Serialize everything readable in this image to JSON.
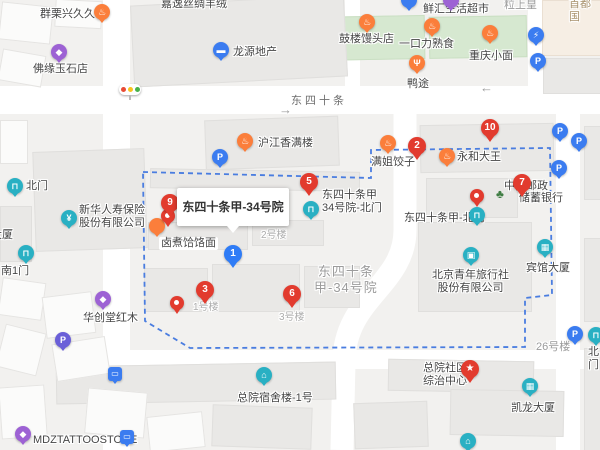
{
  "tooltip": {
    "text": "东四十条甲-34号院"
  },
  "colors": {
    "marker_red": "#e23b2e",
    "marker_blue": "#2f7cf6",
    "marker_teal": "#29b0c3",
    "marker_orange": "#fb7e3b",
    "marker_purple": "#9d62d4",
    "parking_blue": "#3b7cf0",
    "boundary_blue": "#4a7de0",
    "road_white": "#ffffff",
    "map_bg": "#f2f1ef",
    "green_area": "#d6e8d0",
    "building_grey": "#e9e8e6"
  },
  "labels": [
    {
      "text": "群栗兴久久鸭",
      "x": 40,
      "y": 8,
      "name": "label-qunli-duck",
      "inter": true
    },
    {
      "text": "嘉逸丝绸羊绒",
      "x": 161,
      "y": -2,
      "name": "label-jiayi-silk",
      "inter": true
    },
    {
      "text": "佛缘玉石店",
      "x": 33,
      "y": 63,
      "name": "label-foyuan-jade",
      "inter": true
    },
    {
      "text": "龙源地产",
      "x": 233,
      "y": 46,
      "name": "label-longyuan-estate",
      "inter": true
    },
    {
      "text": "鼓楼馒头店",
      "x": 339,
      "y": 33,
      "name": "label-gulou-mantou",
      "inter": true
    },
    {
      "text": "鲜汇生活超市",
      "x": 423,
      "y": 3,
      "name": "label-xianhui-market",
      "inter": true
    },
    {
      "cls": "grey",
      "text": "粒上皇",
      "x": 504,
      "y": -1,
      "name": "label-lishanghuang",
      "inter": false
    },
    {
      "cls": "tan",
      "text": "首都国",
      "x": 569,
      "y": -2,
      "name": "label-shoudu-clipped",
      "inter": false
    },
    {
      "text": "一口力熟食",
      "x": 399,
      "y": 38,
      "name": "label-yikouli-deli",
      "inter": true
    },
    {
      "text": "重庆小面",
      "x": 469,
      "y": 50,
      "name": "label-chongqing-noodles",
      "inter": true
    },
    {
      "text": "鸭途",
      "x": 407,
      "y": 78,
      "name": "label-yatu",
      "inter": true
    },
    {
      "cls": "road",
      "text": "东四十条",
      "x": 291,
      "y": 95,
      "name": "label-road-dongsishitiao",
      "inter": false
    },
    {
      "cls": "arr",
      "text": "→",
      "x": 279,
      "y": 103,
      "name": "arrow-east-icon",
      "inter": false
    },
    {
      "cls": "arr",
      "text": "←",
      "x": 480,
      "y": 81,
      "name": "arrow-west-icon",
      "inter": false
    },
    {
      "text": "北门",
      "x": 26,
      "y": 180,
      "name": "label-north-gate-left",
      "inter": true
    },
    {
      "text": "新华人寿保险\n股份有限公司",
      "x": 79,
      "y": 204,
      "name": "label-xinhua-insurance",
      "inter": true
    },
    {
      "text": "大厦",
      "x": -9,
      "y": 229,
      "name": "label-daxia-clipped",
      "inter": false
    },
    {
      "text": "南1门",
      "x": 1,
      "y": 265,
      "name": "label-south-gate-1",
      "inter": true
    },
    {
      "text": "沪江香满楼",
      "x": 258,
      "y": 137,
      "name": "label-hujiang",
      "inter": true
    },
    {
      "cls": "plate",
      "text": "卤煮饸饹面",
      "x": 159,
      "y": 237,
      "name": "label-luzhu-noodles",
      "inter": true
    },
    {
      "cls": "small",
      "text": "2号楼",
      "x": 261,
      "y": 229,
      "name": "label-bldg-2",
      "inter": false
    },
    {
      "text": "东四十条甲\n34号院-北门",
      "x": 322,
      "y": 189,
      "name": "label-34-north-gate",
      "inter": true
    },
    {
      "text": "满姐饺子",
      "x": 371,
      "y": 156,
      "name": "label-manjie-dumplings",
      "inter": true
    },
    {
      "text": "永和大王",
      "x": 457,
      "y": 151,
      "name": "label-yonghe-king",
      "inter": true
    },
    {
      "text": "中国邮政",
      "x": 504,
      "y": 180,
      "name": "label-psbc-bank-line1",
      "inter": true
    },
    {
      "text": "储蓄银行",
      "x": 519,
      "y": 192,
      "name": "label-psbc-bank-line2",
      "inter": true
    },
    {
      "cls": "tree",
      "text": "♣",
      "x": 496,
      "y": 188,
      "name": "tree-icon",
      "inter": false
    },
    {
      "text": "东四十条甲-北门",
      "x": 404,
      "y": 212,
      "name": "label-jia-north-gate",
      "inter": true
    },
    {
      "text": "宾馆大厦",
      "x": 526,
      "y": 262,
      "name": "label-binguan-tower",
      "inter": true
    },
    {
      "cls": "area",
      "text": "东四十条\n甲-34号院",
      "x": 314,
      "y": 264,
      "name": "label-area-compound",
      "inter": false
    },
    {
      "cls": "ctr",
      "text": "北京青年旅行社\n股份有限公司",
      "x": 432,
      "y": 269,
      "name": "label-youth-travel",
      "inter": true
    },
    {
      "cls": "small",
      "text": "1号楼",
      "x": 193,
      "y": 301,
      "name": "label-bldg-1",
      "inter": false
    },
    {
      "cls": "small",
      "text": "3号楼",
      "x": 279,
      "y": 311,
      "name": "label-bldg-3",
      "inter": false
    },
    {
      "text": "华创堂红木",
      "x": 83,
      "y": 312,
      "name": "label-huachuangtang",
      "inter": true
    },
    {
      "text": "MDZTATTOOSTORE",
      "x": 33,
      "y": 434,
      "name": "label-tattoo-store",
      "inter": true
    },
    {
      "text": "总院宿舍楼-1号",
      "x": 237,
      "y": 392,
      "name": "label-dorm-1",
      "inter": true
    },
    {
      "text": "总院社区\n综治中心",
      "x": 423,
      "y": 362,
      "name": "label-community-center",
      "inter": true
    },
    {
      "cls": "grey",
      "text": "26号楼",
      "x": 536,
      "y": 341,
      "name": "label-bldg-26",
      "inter": false
    },
    {
      "text": "凯龙大厦",
      "x": 511,
      "y": 402,
      "name": "label-kailong-tower",
      "inter": true
    },
    {
      "text": "北门",
      "x": 588,
      "y": 346,
      "name": "label-north-gate-right-clipped",
      "inter": true
    }
  ],
  "markers": [
    {
      "k": "rm",
      "c": "orange",
      "icon": "food-icon",
      "g": "♨",
      "x": 102,
      "y": 12,
      "name": "marker-qunli-duck"
    },
    {
      "k": "rm",
      "c": "purple",
      "icon": "shopping-bag-icon",
      "g": "◆",
      "x": 59,
      "y": 52,
      "name": "marker-jade-shop"
    },
    {
      "k": "rm",
      "c": "pblue",
      "icon": "company-icon",
      "g": "▬",
      "x": 221,
      "y": 50,
      "name": "marker-longyuan"
    },
    {
      "k": "rm",
      "c": "orange",
      "icon": "food-icon",
      "g": "♨",
      "x": 367,
      "y": 22,
      "name": "marker-gulou-mantou"
    },
    {
      "k": "rm",
      "c": "pblue",
      "icon": "supermarket-icon",
      "g": "",
      "x": 409,
      "y": 0,
      "name": "marker-xianhui-clipped"
    },
    {
      "k": "rm",
      "c": "purple",
      "icon": "shopping-bag-icon",
      "g": "",
      "x": 451,
      "y": 0,
      "name": "marker-top-clipped"
    },
    {
      "k": "rm",
      "c": "orange",
      "icon": "food-icon",
      "g": "♨",
      "x": 432,
      "y": 26,
      "name": "marker-yikouli-deli"
    },
    {
      "k": "rm",
      "c": "orange",
      "icon": "food-icon",
      "g": "♨",
      "x": 490,
      "y": 33,
      "name": "marker-chongqing-noodles"
    },
    {
      "k": "rm",
      "c": "orange",
      "icon": "restaurant-icon",
      "g": "Ψ",
      "x": 417,
      "y": 63,
      "name": "marker-yatu"
    },
    {
      "k": "rm",
      "c": "pblue",
      "icon": "ev-charging-icon",
      "g": "⚡",
      "x": 536,
      "y": 35,
      "name": "marker-charging-parking"
    },
    {
      "k": "rm",
      "c": "pblue",
      "icon": "parking-icon",
      "g": "P",
      "x": 538,
      "y": 61,
      "name": "marker-parking-1"
    },
    {
      "k": "tl",
      "x": 130,
      "y": 90,
      "name": "traffic-light-icon"
    },
    {
      "k": "rm",
      "c": "teal",
      "icon": "gate-icon",
      "g": "⊓",
      "x": 15,
      "y": 186,
      "name": "marker-north-gate-left"
    },
    {
      "k": "rm",
      "c": "teal",
      "icon": "yuan-icon",
      "g": "¥",
      "x": 69,
      "y": 218,
      "name": "marker-xinhua-insurance"
    },
    {
      "k": "rm",
      "c": "teal",
      "icon": "gate-icon",
      "g": "⊓",
      "x": 26,
      "y": 253,
      "name": "marker-south-gate-1"
    },
    {
      "k": "rm",
      "c": "orange",
      "icon": "food-icon",
      "g": "♨",
      "x": 245,
      "y": 141,
      "name": "marker-hujiang"
    },
    {
      "k": "rm",
      "c": "pblue",
      "icon": "parking-icon",
      "g": "P",
      "x": 220,
      "y": 157,
      "name": "marker-parking-2"
    },
    {
      "k": "rm",
      "c": "orange",
      "icon": "thumbs-up-icon",
      "g": "♨",
      "x": 388,
      "y": 143,
      "name": "marker-manjie-dumplings"
    },
    {
      "k": "rm",
      "c": "orange",
      "icon": "food-icon",
      "g": "♨",
      "x": 447,
      "y": 156,
      "name": "marker-yonghe-king"
    },
    {
      "k": "num",
      "n": "2",
      "c": "red",
      "x": 417,
      "y": 146,
      "name": "marker-2"
    },
    {
      "k": "num",
      "n": "10",
      "c": "red",
      "x": 490,
      "y": 128,
      "name": "marker-10"
    },
    {
      "k": "num",
      "n": "5",
      "c": "red",
      "x": 309,
      "y": 182,
      "name": "marker-5"
    },
    {
      "k": "rm",
      "c": "teal",
      "icon": "gate-icon",
      "g": "⊓",
      "x": 311,
      "y": 209,
      "name": "marker-34-north-gate"
    },
    {
      "k": "num",
      "n": "7",
      "c": "red",
      "x": 522,
      "y": 183,
      "name": "marker-7"
    },
    {
      "k": "rm",
      "c": "teal",
      "icon": "gate-icon",
      "g": "⊓",
      "x": 477,
      "y": 215,
      "name": "marker-jia-north-gate"
    },
    {
      "k": "dot",
      "x": 477,
      "y": 196,
      "name": "pin-jia-north-gate"
    },
    {
      "k": "rm",
      "c": "pblue",
      "icon": "parking-icon",
      "g": "P",
      "x": 560,
      "y": 131,
      "name": "marker-parking-3"
    },
    {
      "k": "rm",
      "c": "pblue",
      "icon": "parking-icon",
      "g": "P",
      "x": 579,
      "y": 141,
      "name": "marker-parking-4"
    },
    {
      "k": "rm",
      "c": "pblue",
      "icon": "parking-entrance-icon",
      "g": "P",
      "x": 559,
      "y": 168,
      "name": "marker-parking-entrance"
    },
    {
      "k": "rm",
      "c": "orange",
      "icon": "food-icon",
      "g": "",
      "x": 157,
      "y": 226,
      "name": "marker-luzhu-hidden"
    },
    {
      "k": "dot",
      "x": 168,
      "y": 216,
      "name": "pin-luzhu"
    },
    {
      "k": "num",
      "n": "9",
      "c": "red",
      "x": 170,
      "y": 203,
      "name": "marker-9"
    },
    {
      "k": "num",
      "n": "1",
      "c": "blue",
      "x": 233,
      "y": 254,
      "name": "marker-1"
    },
    {
      "k": "rm",
      "c": "teal",
      "icon": "briefcase-icon",
      "g": "▣",
      "x": 471,
      "y": 255,
      "name": "marker-youth-travel"
    },
    {
      "k": "rm",
      "c": "teal",
      "icon": "building-icon",
      "g": "▦",
      "x": 545,
      "y": 247,
      "name": "marker-binguan-tower"
    },
    {
      "k": "num",
      "n": "3",
      "c": "red",
      "x": 205,
      "y": 290,
      "name": "marker-3"
    },
    {
      "k": "num",
      "n": "6",
      "c": "red",
      "x": 292,
      "y": 294,
      "name": "marker-6"
    },
    {
      "k": "dot",
      "x": 177,
      "y": 303,
      "name": "pin-bottom-left"
    },
    {
      "k": "rm",
      "c": "purple",
      "icon": "shopping-bag-icon",
      "g": "◆",
      "x": 103,
      "y": 299,
      "name": "marker-huachuangtang"
    },
    {
      "k": "rm",
      "c": "indigo",
      "icon": "parking-icon",
      "g": "P",
      "x": 63,
      "y": 340,
      "name": "marker-parking-purple"
    },
    {
      "k": "bus",
      "x": 115,
      "y": 374,
      "name": "bus-stop-marker-1"
    },
    {
      "k": "bus",
      "x": 127,
      "y": 437,
      "name": "bus-stop-marker-2"
    },
    {
      "k": "rm",
      "c": "purple",
      "icon": "shopping-bag-icon",
      "g": "◆",
      "x": 23,
      "y": 434,
      "name": "marker-tattoo-store"
    },
    {
      "k": "rm",
      "c": "teal",
      "icon": "bed-icon",
      "g": "⌂",
      "x": 264,
      "y": 375,
      "name": "marker-dorm-1"
    },
    {
      "k": "num",
      "n": "★",
      "c": "red",
      "x": 470,
      "y": 369,
      "name": "marker-community-center-star"
    },
    {
      "k": "rm",
      "c": "pblue",
      "icon": "parking-icon",
      "g": "P",
      "x": 575,
      "y": 334,
      "name": "marker-parking-5"
    },
    {
      "k": "rm",
      "c": "teal",
      "icon": "gate-icon",
      "g": "⊓",
      "x": 596,
      "y": 335,
      "name": "marker-north-gate-right-clipped"
    },
    {
      "k": "rm",
      "c": "teal",
      "icon": "building-icon",
      "g": "▦",
      "x": 530,
      "y": 386,
      "name": "marker-kailong-tower"
    },
    {
      "k": "rm",
      "c": "teal",
      "icon": "poi-icon",
      "g": "⌂",
      "x": 468,
      "y": 441,
      "name": "marker-bottom-clipped"
    }
  ]
}
